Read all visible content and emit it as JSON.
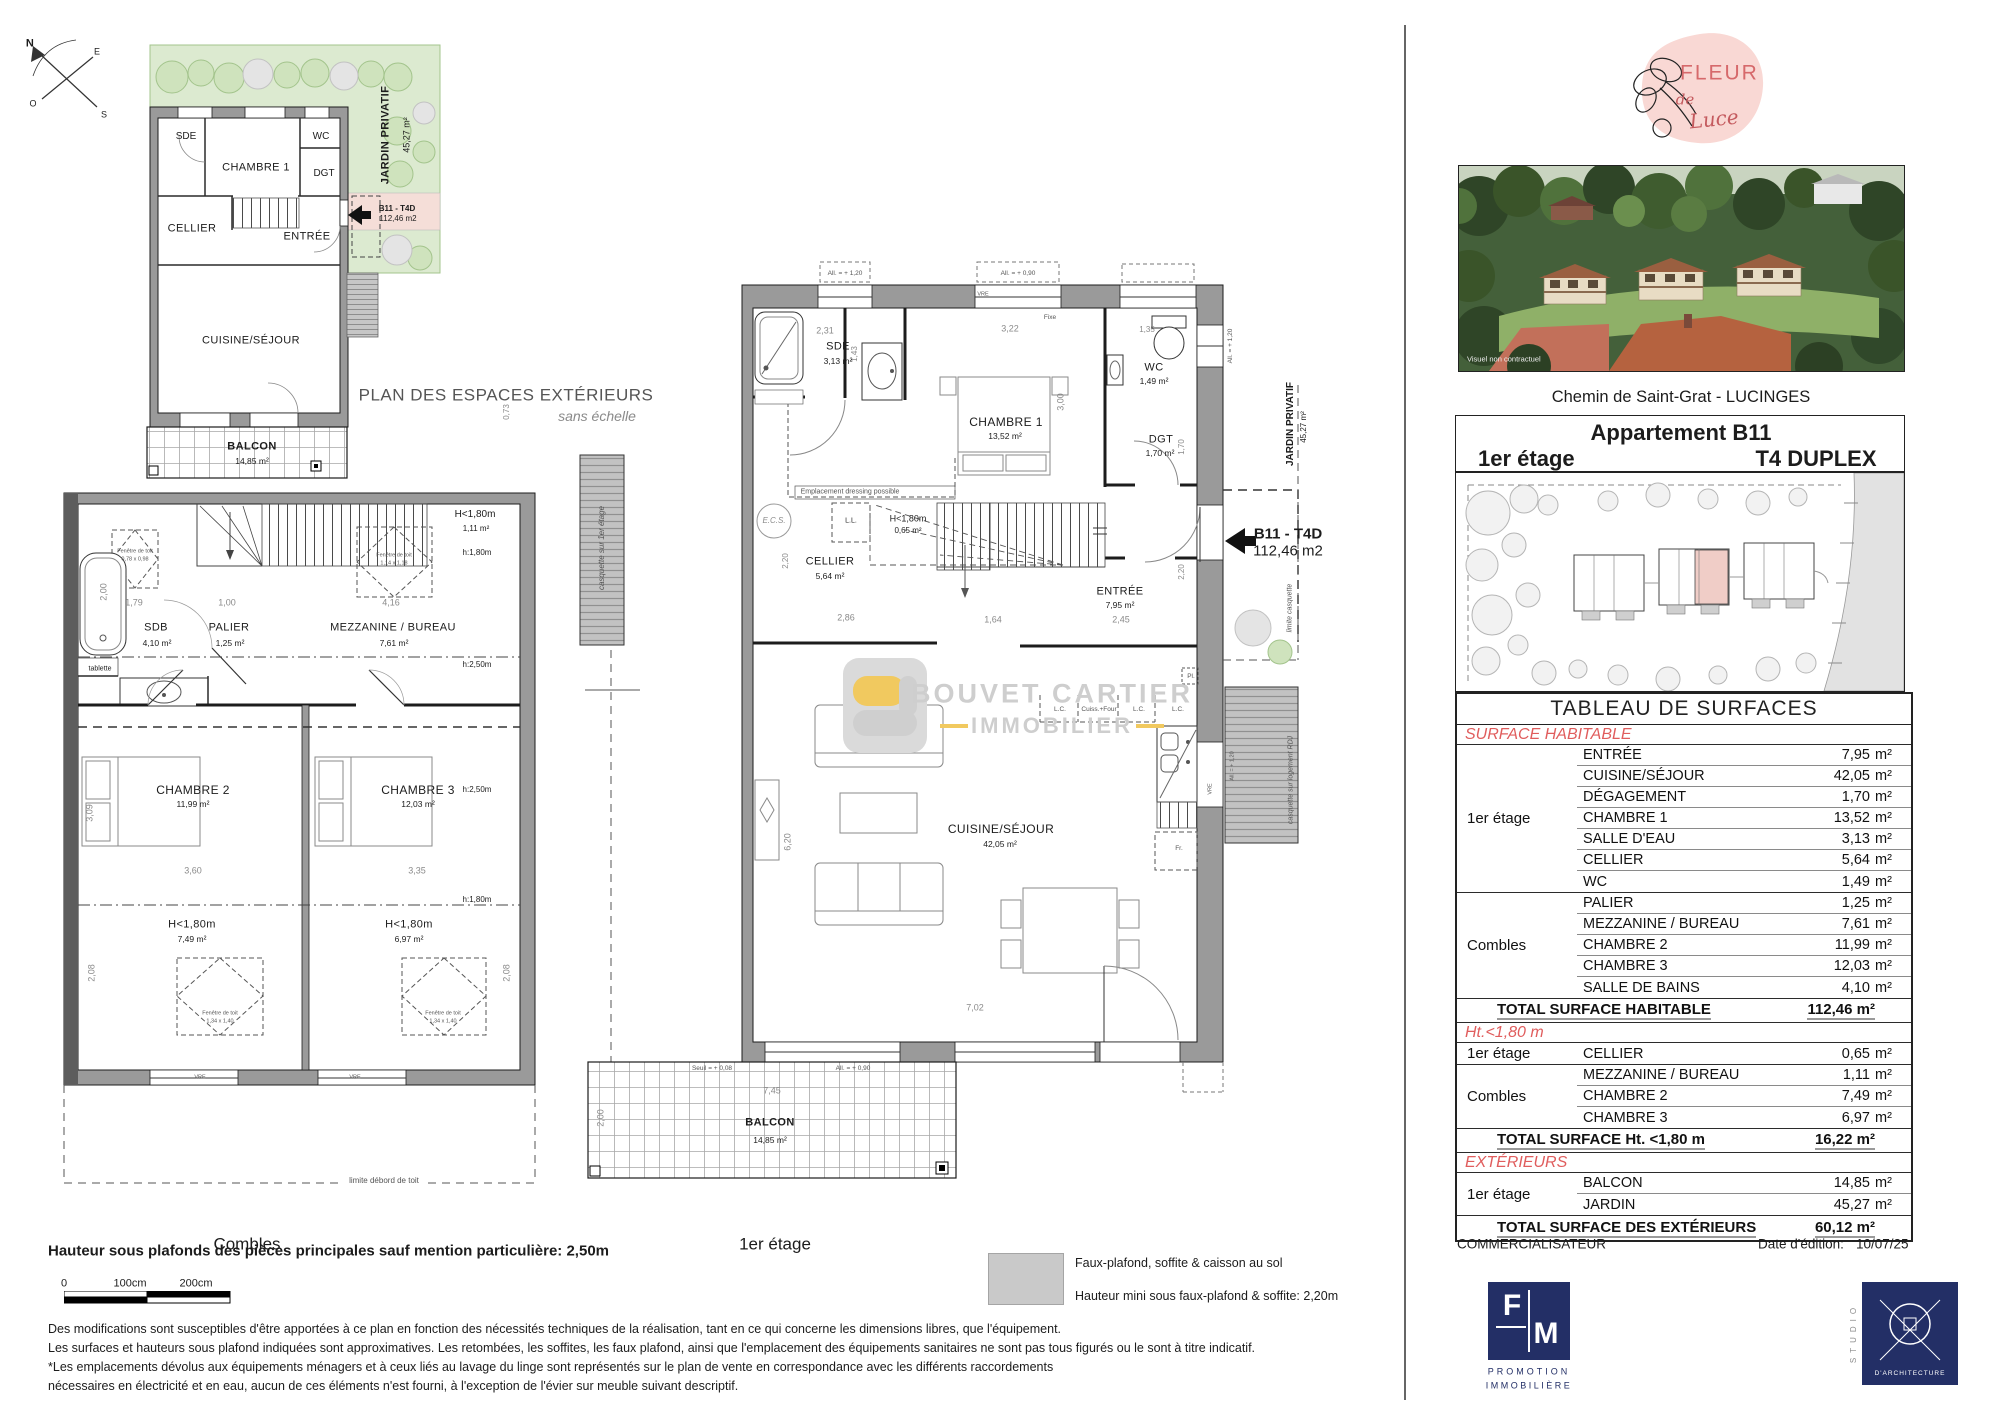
{
  "plans": {
    "exterior": {
      "title": "PLAN DES ESPACES EXTÉRIEURS",
      "subtitle": "sans échelle",
      "compass": {
        "n": "N",
        "e": "E",
        "s": "S",
        "o": "O"
      },
      "labels": {
        "sde": "SDE",
        "chambre1": "CHAMBRE 1",
        "wc": "WC",
        "dgt": "DGT",
        "cellier": "CELLIER",
        "entree": "ENTRÉE",
        "cuisine": "CUISINE/SÉJOUR",
        "balcon": "BALCON",
        "balcon_area": "14,85 m²",
        "jardin": "JARDIN PRIVATIF",
        "jardin_area": "45,27 m²",
        "unit": "B11 - T4D",
        "unit_area": "112,46 m2"
      }
    },
    "combles": {
      "floor_label": "Combles",
      "rooms": {
        "sdb": "SDB",
        "sdb_area": "4,10 m²",
        "palier": "PALIER",
        "palier_area": "1,25 m²",
        "mezzanine": "MEZZANINE / BUREAU",
        "mezzanine_area": "7,61 m²",
        "chambre2": "CHAMBRE 2",
        "chambre2_area": "11,99 m²",
        "chambre3": "CHAMBRE 3",
        "chambre3_area": "12,03 m²",
        "h180_top": "H<1,80m",
        "h180_top_area": "1,11 m²",
        "h180_left": "H<1,80m",
        "h180_left_area": "7,49 m²",
        "h180_right": "H<1,80m",
        "h180_right_area": "6,97 m²"
      },
      "heights": {
        "h250": "h:2,50m",
        "h180": "h:1,80m"
      },
      "roof_windows": {
        "label": "Fenêtre de toit",
        "s1": "0,78 x 0,98",
        "s2": "1,14 x 1,18",
        "s3": "1,34 x 1,40"
      },
      "annotations": {
        "tablette": "tablette",
        "casquette": "casquette sur 1er étage",
        "limite_toit": "limite débord de toit",
        "vre": "VRE"
      },
      "dims": [
        "2,00",
        "1,79",
        "1,00",
        "4,16",
        "0,73",
        "3,60",
        "3,35",
        "3,09",
        "2,08",
        "2,08"
      ]
    },
    "etage1": {
      "floor_label": "1er étage",
      "rooms": {
        "sde": "SDE",
        "sde_area": "3,13 m²",
        "chambre1": "CHAMBRE 1",
        "chambre1_area": "13,52 m²",
        "wc": "WC",
        "wc_area": "1,49 m²",
        "dgt": "DGT",
        "dgt_area": "1,70 m²",
        "cellier": "CELLIER",
        "cellier_area": "5,64 m²",
        "entree": "ENTRÉE",
        "entree_area": "7,95 m²",
        "h180": "H<1,80m",
        "h180_area": "0,65 m²",
        "cuisine": "CUISINE/SÉJOUR",
        "cuisine_area": "42,05 m²",
        "balcon": "BALCON",
        "balcon_area": "14,85 m²"
      },
      "annotations": {
        "all120": "All. = + 1,20",
        "all090": "All. = + 0,90",
        "vre": "VRE",
        "fixe": "Fixe",
        "dressing": "Emplacement dressing possible",
        "ecs": "E.C.S.",
        "ll": "L.L.",
        "lc": "L.C.",
        "cuisson": "Cuiss.+Four",
        "pl": "Pl.",
        "fr": "Fr.",
        "jardin": "JARDIN PRIVATIF",
        "jardin_area": "45,27 m²",
        "limite_casquette": "limite casquette",
        "casquette_rdj": "casquette sur logement RDJ",
        "seuil": "Seuil = + 0,08",
        "unit": "B11 - T4D",
        "unit_area": "112,46 m2"
      },
      "dims": [
        "2,31",
        "1,43",
        "3,22",
        "3,00",
        "1,35",
        "1,70",
        "2,20",
        "2,86",
        "1,64",
        "2,45",
        "2,20",
        "6,20",
        "7,02",
        "7,45",
        "2,00"
      ]
    }
  },
  "watermark": {
    "line1": "BOUVET CARTIER",
    "line2": "IMMOBILIER"
  },
  "right_panel": {
    "logo": {
      "word1": "FLEUR",
      "word2": "de",
      "word3": "Luce"
    },
    "photo_caption": "Visuel non contractuel",
    "address": "Chemin de Saint-Grat - LUCINGES",
    "apartment": {
      "title": "Appartement B11",
      "floor": "1er étage",
      "type": "T4 DUPLEX"
    },
    "surface_table": {
      "title": "TABLEAU DE SURFACES",
      "unit": "m²",
      "sections": [
        {
          "header": "SURFACE HABITABLE",
          "groups": [
            {
              "label": "1er étage",
              "rows": [
                [
                  "ENTRÉE",
                  "7,95"
                ],
                [
                  "CUISINE/SÉJOUR",
                  "42,05"
                ],
                [
                  "DÉGAGEMENT",
                  "1,70"
                ],
                [
                  "CHAMBRE 1",
                  "13,52"
                ],
                [
                  "SALLE D'EAU",
                  "3,13"
                ],
                [
                  "CELLIER",
                  "5,64"
                ],
                [
                  "WC",
                  "1,49"
                ]
              ]
            },
            {
              "label": "Combles",
              "rows": [
                [
                  "PALIER",
                  "1,25"
                ],
                [
                  "MEZZANINE / BUREAU",
                  "7,61"
                ],
                [
                  "CHAMBRE 2",
                  "11,99"
                ],
                [
                  "CHAMBRE 3",
                  "12,03"
                ],
                [
                  "SALLE DE BAINS",
                  "4,10"
                ]
              ]
            }
          ],
          "total_label": "TOTAL SURFACE HABITABLE",
          "total_value": "112,46 m²"
        },
        {
          "header": "Ht.<1,80 m",
          "groups": [
            {
              "label": "1er étage",
              "rows": [
                [
                  "CELLIER",
                  "0,65"
                ]
              ]
            },
            {
              "label": "Combles",
              "rows": [
                [
                  "MEZZANINE / BUREAU",
                  "1,11"
                ],
                [
                  "CHAMBRE 2",
                  "7,49"
                ],
                [
                  "CHAMBRE 3",
                  "6,97"
                ]
              ]
            }
          ],
          "total_label": "TOTAL SURFACE Ht. <1,80 m",
          "total_value": "16,22 m²"
        },
        {
          "header": "EXTÉRIEURS",
          "groups": [
            {
              "label": "1er étage",
              "rows": [
                [
                  "BALCON",
                  "14,85"
                ],
                [
                  "JARDIN",
                  "45,27"
                ]
              ]
            }
          ],
          "total_label": "TOTAL SURFACE  DES EXTÉRIEURS",
          "total_value": "60,12 m²"
        }
      ]
    },
    "commercialisateur": "COMMERCIALISATEUR",
    "edition": {
      "label": "Date d'édition:",
      "value": "10/07/25"
    },
    "fim": {
      "f": "F",
      "m": "M",
      "line1": "PROMOTION",
      "line2": "IMMOBILIÈRE"
    },
    "studio": {
      "vertical": "STUDIO",
      "label": "D'ARCHITECTURE"
    }
  },
  "footer": {
    "height_note": "Hauteur sous plafonds des pièces principales sauf mention particulière: 2,50m",
    "scale": {
      "t0": "0",
      "t1": "100cm",
      "t2": "200cm"
    },
    "legend_line1": "Faux-plafond, soffite & caisson au sol",
    "legend_line2": "Hauteur mini sous faux-plafond & soffite: 2,20m",
    "disclaimer": [
      "Des modifications sont susceptibles d'être apportées à ce plan en fonction des nécessités techniques de la réalisation, tant en ce qui concerne les dimensions libres, que l'équipement.",
      "Les surfaces et hauteurs sous plafond indiquées sont approximatives. Les retombées, les soffites, les faux plafond, ainsi que l'emplacement des équipements sanitaires ne sont pas tous figurés ou le sont à titre indicatif.",
      "*Les emplacements dévolus aux équipements ménagers et à ceux liés au lavage du linge sont représentés sur le plan de vente en correspondance avec les différents raccordements",
      "nécessaires en électricité et en eau, aucun de ces éléments n'est fourni, à l'exception de l'évier sur meuble suivant descriptif."
    ]
  }
}
